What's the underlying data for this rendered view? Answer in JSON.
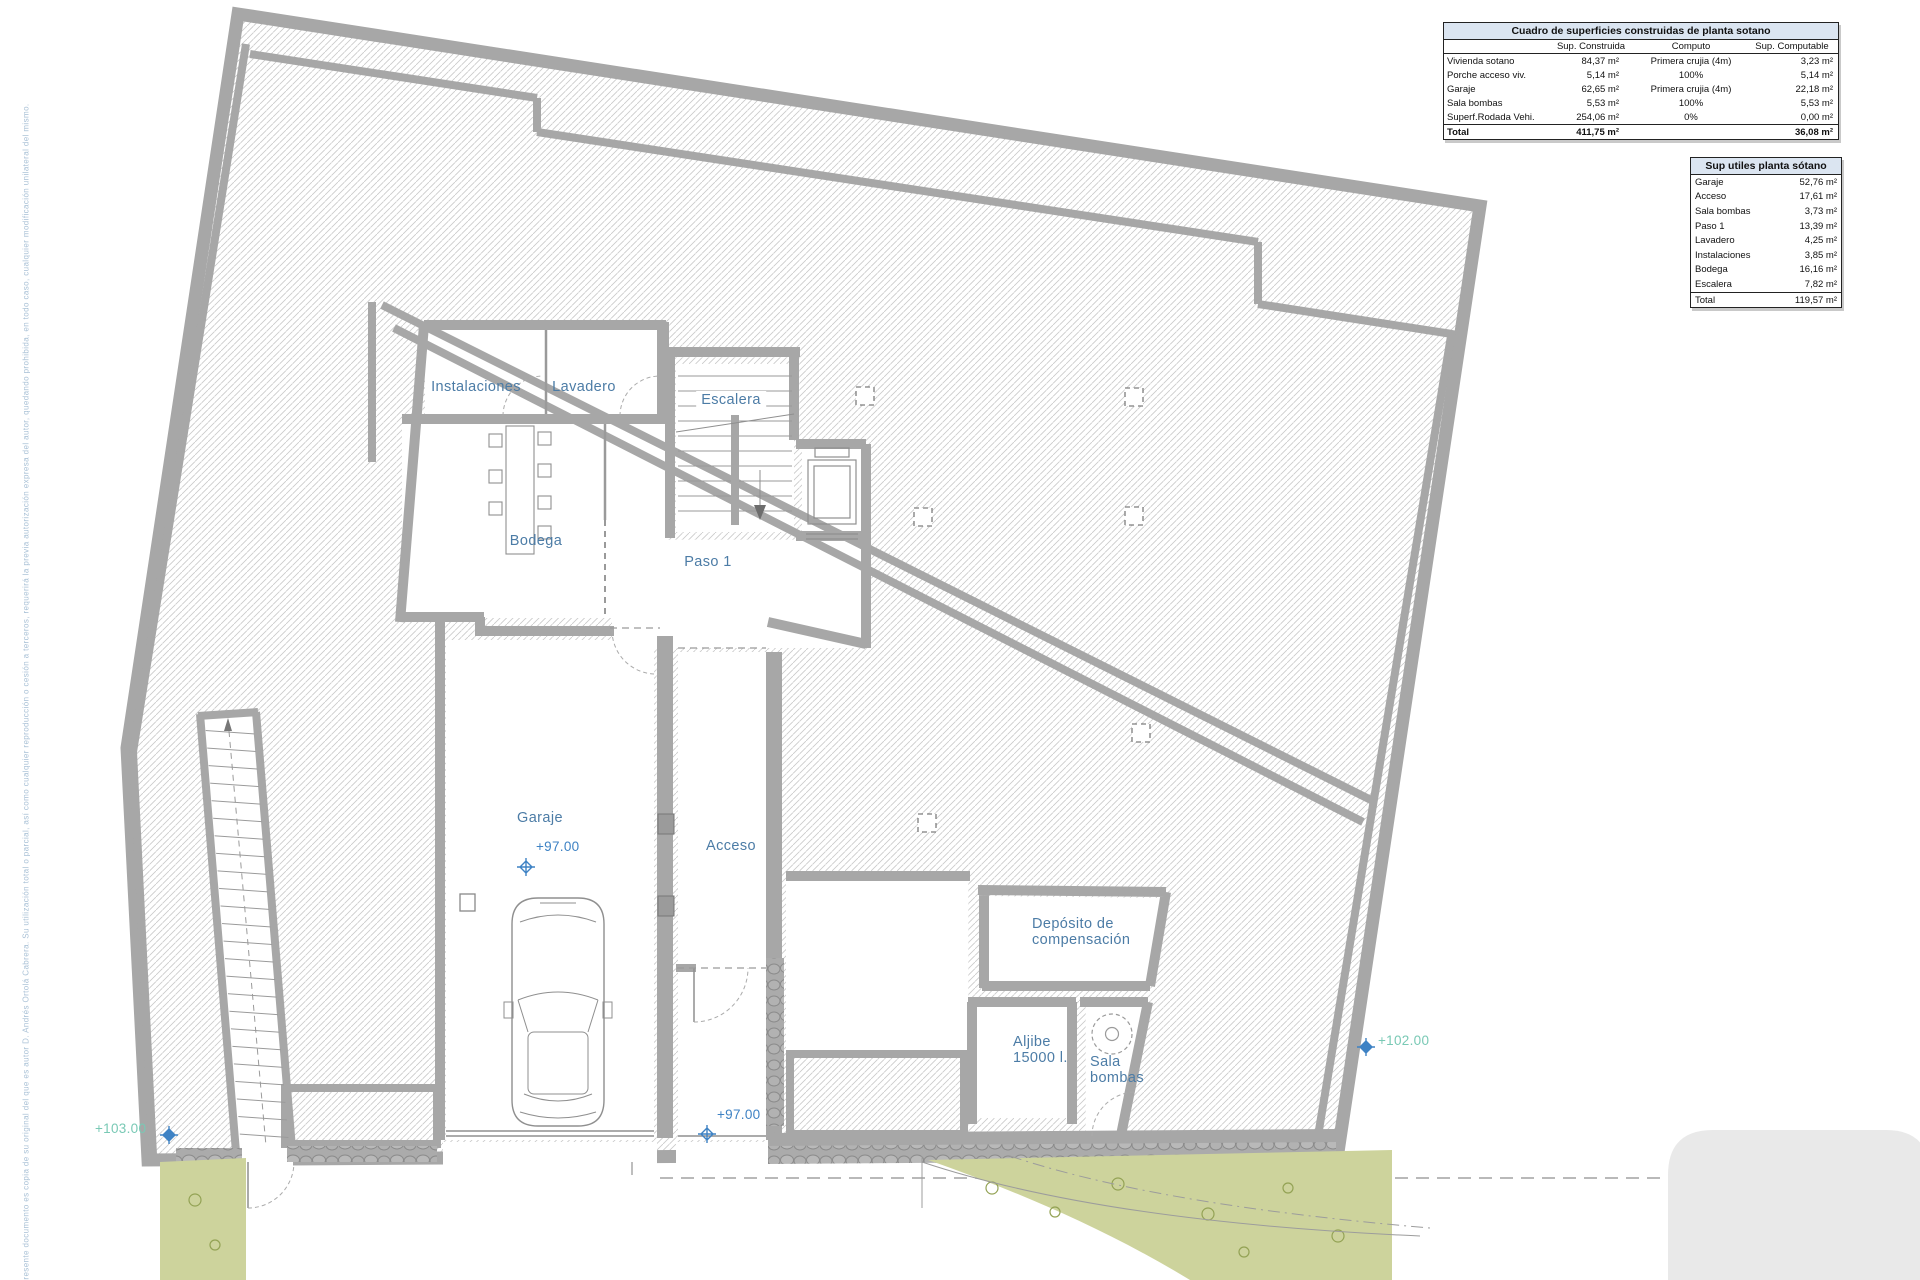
{
  "tables": {
    "t1": {
      "title": "Cuadro de superficies construidas de planta sotano",
      "columns": [
        "",
        "Sup. Construida",
        "Computo",
        "Sup. Computable"
      ],
      "rows": [
        [
          "Vivienda sotano",
          "84,37 m²",
          "Primera crujia (4m)",
          "3,23 m²"
        ],
        [
          "Porche acceso viv.",
          "5,14 m²",
          "100%",
          "5,14 m²"
        ],
        [
          "Garaje",
          "62,65 m²",
          "Primera crujia (4m)",
          "22,18 m²"
        ],
        [
          "Sala bombas",
          "5,53 m²",
          "100%",
          "5,53 m²"
        ],
        [
          "Superf.Rodada Vehi.",
          "254,06 m²",
          "0%",
          "0,00 m²"
        ]
      ],
      "total": [
        "Total",
        "411,75 m²",
        "",
        "36,08 m²"
      ]
    },
    "t2": {
      "title": "Sup utiles planta sótano",
      "rows": [
        [
          "Garaje",
          "52,76 m²"
        ],
        [
          "Acceso",
          "17,61 m²"
        ],
        [
          "Sala bombas",
          "3,73 m²"
        ],
        [
          "Paso 1",
          "13,39 m²"
        ],
        [
          "Lavadero",
          "4,25 m²"
        ],
        [
          "Instalaciones",
          "3,85 m²"
        ],
        [
          "Bodega",
          "16,16 m²"
        ],
        [
          "Escalera",
          "7,82 m²"
        ]
      ],
      "total": [
        "Total",
        "119,57 m²"
      ]
    }
  },
  "plan": {
    "labels": {
      "instalaciones": "Instalaciones",
      "lavadero": "Lavadero",
      "escalera": "Escalera",
      "bodega": "Bodega",
      "paso1": "Paso 1",
      "garaje": "Garaje",
      "acceso": "Acceso",
      "deposito_line1": "Depósito de",
      "deposito_line2": "compensación",
      "aljibe_line1": "Aljibe",
      "aljibe_line2": "15000 l.",
      "sala_line1": "Sala",
      "sala_line2": "bombas"
    },
    "levels": {
      "garaje": "+97.00",
      "acceso": "+97.00",
      "right": "+102.00",
      "left": "+103.00"
    },
    "colors": {
      "wall_gray": "#a7a7a7",
      "hatch_line": "#c9c9c9",
      "label_blue": "#4c7ca6",
      "level_blue": "#3e82c4",
      "level_teal": "#79c9b5",
      "table_header_bg": "#dbe5f1",
      "landscape_green": "#cdd39c"
    }
  },
  "note": "El presente documento es copia de su original del que es autor D. Andrés Ortolá Cabrera. Su utilización total o parcial, así como cualquier reproducción o cesión a terceros, requerirá la previa autorización expresa del autor, quedando prohibida, en todo caso, cualquier modificación unilateral del mismo."
}
